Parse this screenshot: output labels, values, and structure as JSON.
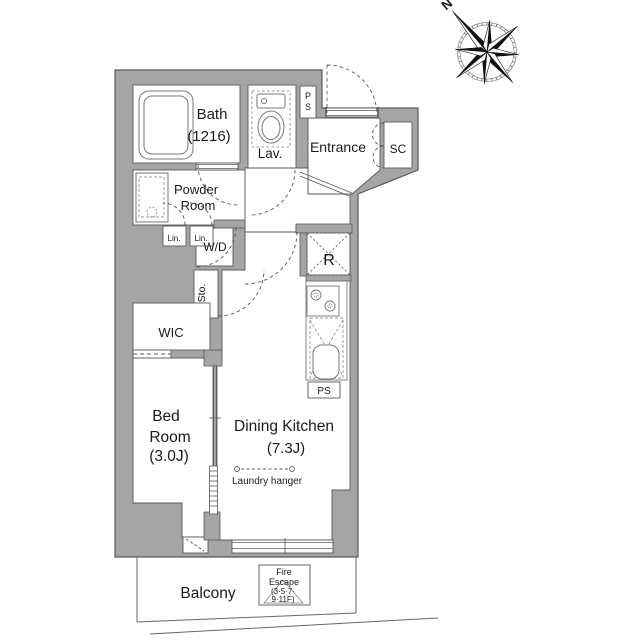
{
  "plan": {
    "rooms": {
      "bath": {
        "name": "Bath",
        "size": "(1216)"
      },
      "lavatory": {
        "name": "Lav."
      },
      "pipe_space_upper": {
        "letters": [
          "P",
          "S"
        ]
      },
      "entrance": {
        "name": "Entrance"
      },
      "shoe_closet": {
        "name": "SC"
      },
      "powder_room": {
        "name_line1": "Powder",
        "name_line2": "Room"
      },
      "linen_closet_1": {
        "name": "Lin."
      },
      "linen_closet_2": {
        "name": "Lin."
      },
      "washer_dryer": {
        "name": "W/D"
      },
      "storage": {
        "name": "Sto."
      },
      "walk_in_closet": {
        "name": "WIC"
      },
      "refrigerator_space": {
        "name": "R"
      },
      "bedroom": {
        "name_line1": "Bed",
        "name_line2": "Room",
        "size": "(3.0J)"
      },
      "dining_kitchen": {
        "name": "Dining Kitchen",
        "size": "(7.3J)"
      },
      "pipe_space_lower": {
        "name": "PS"
      },
      "balcony": {
        "name": "Balcony"
      }
    },
    "annotations": {
      "laundry_hanger": "Laundry hanger",
      "fire_escape": {
        "line1": "Fire",
        "line2": "Escape",
        "line3": "(3·5·7·",
        "line4": "9·11F)"
      },
      "compass_north": "N"
    },
    "colors": {
      "wall": "#a5a5a5",
      "outline": "#5a5a5a",
      "text": "#1a1a1a"
    }
  }
}
